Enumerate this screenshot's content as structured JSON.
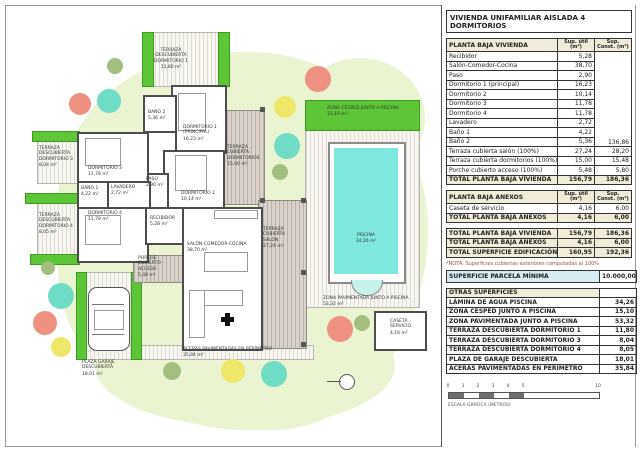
{
  "colors": {
    "garden": "#eaf4d0",
    "hedge": "#5cc636",
    "pool": "#7fe8de",
    "cdeck": "#d8d2ca",
    "wall": "#4d4d4d",
    "thbg": "#f0ecd8",
    "parcelabg": "#d6ebf2",
    "nota": "#a05040",
    "scaledark": "#6e6e6e",
    "tree_salmon": "#ef9180",
    "tree_teal": "#6fdcc6",
    "tree_yellow": "#efe769",
    "tree_olive": "#a3bf7f"
  },
  "plan": {
    "labels": [
      {
        "n": "TERRAZA DESCUBIERTA DORMITORIO 1",
        "a": "11,80 m²"
      },
      {
        "n": "TERRAZA DESCUBIERTA DORMITORIO 3",
        "a": "8,04 m²"
      },
      {
        "n": "TERRAZA DESCUBIERTA DORMITORIO 4",
        "a": "8,05 m²"
      },
      {
        "n": "BAÑO 2",
        "a": "5,36 m²"
      },
      {
        "n": "DORMITORIO 1 (PRINCIPAL)",
        "a": "16,23 m²"
      },
      {
        "n": "DORMITORIO 3",
        "a": "11,78 m²"
      },
      {
        "n": "PASO",
        "a": "2,90 m²"
      },
      {
        "n": "BAÑO 1",
        "a": "4,22 m²"
      },
      {
        "n": "LAVADERO",
        "a": "2,72 m²"
      },
      {
        "n": "DORMITORIO 2",
        "a": "10,14 m²"
      },
      {
        "n": "DORMITORIO 4",
        "a": "11,78 m²"
      },
      {
        "n": "RECIBIDOR",
        "a": "5,28 m²"
      },
      {
        "n": "SALÓN-COMEDOR-COCINA",
        "a": "38,70 m²"
      },
      {
        "n": "PORCHE CUBIERTO ACCESO",
        "a": "5,48 m²"
      },
      {
        "n": "TERRAZA CUBIERTA DORMITORIOS",
        "a": "15,00 m²"
      },
      {
        "n": "TERRAZA CUBIERTA SALÓN",
        "a": "27,24 m²"
      },
      {
        "n": "ZONA CÉSPED JUNTO A PISCINA",
        "a": "15,10 m²"
      },
      {
        "n": "PISCINA",
        "a": "34,26 m²"
      },
      {
        "n": "ZONA PAVIMENTADA JUNTO A PISCINA",
        "a": "53,32 m²"
      },
      {
        "n": "CASETA SERVICIO",
        "a": "4,16 m²"
      },
      {
        "n": "PLAZA GARAJE DESCUBIERTA",
        "a": "18,01 m²"
      },
      {
        "n": "ACERAS PAVIMENTADAS EN PERÍMETRO",
        "a": "35,84 m²"
      }
    ]
  },
  "panel": {
    "title": "VIVIENDA UNIFAMILIAR AISLADA 4 DORMITORIOS",
    "vivienda": {
      "header": "PLANTA BAJA VIVIENDA",
      "col_util": "Sup. útil (m²)",
      "col_const": "Sup. Const. (m²)",
      "const_merged": "136,86",
      "rows": [
        {
          "n": "Recibidor",
          "u": "5,28"
        },
        {
          "n": "Salón-Comedor-Cocina",
          "u": "38,70"
        },
        {
          "n": "Paso",
          "u": "2,90"
        },
        {
          "n": "Dormitorio 1 (principal)",
          "u": "16,23"
        },
        {
          "n": "Dormitorio 2",
          "u": "10,14"
        },
        {
          "n": "Dormitorio 3",
          "u": "11,78"
        },
        {
          "n": "Dormitorio 4",
          "u": "11,78"
        },
        {
          "n": "Lavadero",
          "u": "2,72"
        },
        {
          "n": "Baño 1",
          "u": "4,22"
        },
        {
          "n": "Baño 2",
          "u": "5,36"
        },
        {
          "n": "Terraza cubierta salón (100%)",
          "u": "27,24",
          "c": "28,20"
        },
        {
          "n": "Terraza cubierta dormitorios (100%)",
          "u": "15,00",
          "c": "15,48"
        },
        {
          "n": "Porche cubierto acceso (100%)",
          "u": "5,48",
          "c": "5,80"
        }
      ],
      "total": {
        "n": "TOTAL PLANTA BAJA VIVIENDA",
        "u": "156,79",
        "c": "186,36"
      }
    },
    "anexos": {
      "header": "PLANTA BAJA ANEXOS",
      "col_util": "Sup. útil (m²)",
      "col_const": "Sup. Const. (m²)",
      "rows": [
        {
          "n": "Caseta de servicio",
          "u": "4,16",
          "c": "6,00"
        }
      ],
      "total": {
        "n": "TOTAL PLANTA BAJA ANEXOS",
        "u": "4,16",
        "c": "6,00"
      }
    },
    "resumen": {
      "rows": [
        {
          "n": "TOTAL PLANTA BAJA VIVIENDA",
          "u": "156,79",
          "c": "186,36"
        },
        {
          "n": "TOTAL PLANTA BAJA ANEXOS",
          "u": "4,16",
          "c": "6,00"
        },
        {
          "n": "TOTAL SUPERFICIE EDIFICACIÓN",
          "u": "160,95",
          "c": "192,36"
        }
      ]
    },
    "nota": "*NOTA: Superficies cubiertas exteriores computadas al 100%",
    "parcela": {
      "n": "SUPERFICIE PARCELA MÍNIMA",
      "v": "10.000,00"
    },
    "otras": {
      "header": "OTRAS SUPERFICIES",
      "rows": [
        {
          "n": "LÁMINA DE AGUA PISCINA",
          "v": "34,26"
        },
        {
          "n": "ZONA CÉSPED JUNTO A PISCINA",
          "v": "15,10"
        },
        {
          "n": "ZONA PAVIMENTADA JUNTO A PISCINA",
          "v": "53,32"
        },
        {
          "n": "TERRAZA DESCUBIERTA DORMITORIO 1",
          "v": "11,80"
        },
        {
          "n": "TERRAZA DESCUBIERTA DORMITORIO 3",
          "v": "8,04"
        },
        {
          "n": "TERRAZA DESCUBIERTA DORMITORIO 4",
          "v": "8,05"
        },
        {
          "n": "PLAZA DE GARAJE DESCUBIERTA",
          "v": "18,01"
        },
        {
          "n": "ACERAS PAVIMENTADAS EN PERÍMETRO",
          "v": "35,84"
        }
      ]
    },
    "scale": {
      "ticks": [
        "0",
        "1",
        "2",
        "3",
        "4",
        "5"
      ],
      "end": "10",
      "label": "ESCALA GRÁFICA (METROS)"
    }
  }
}
